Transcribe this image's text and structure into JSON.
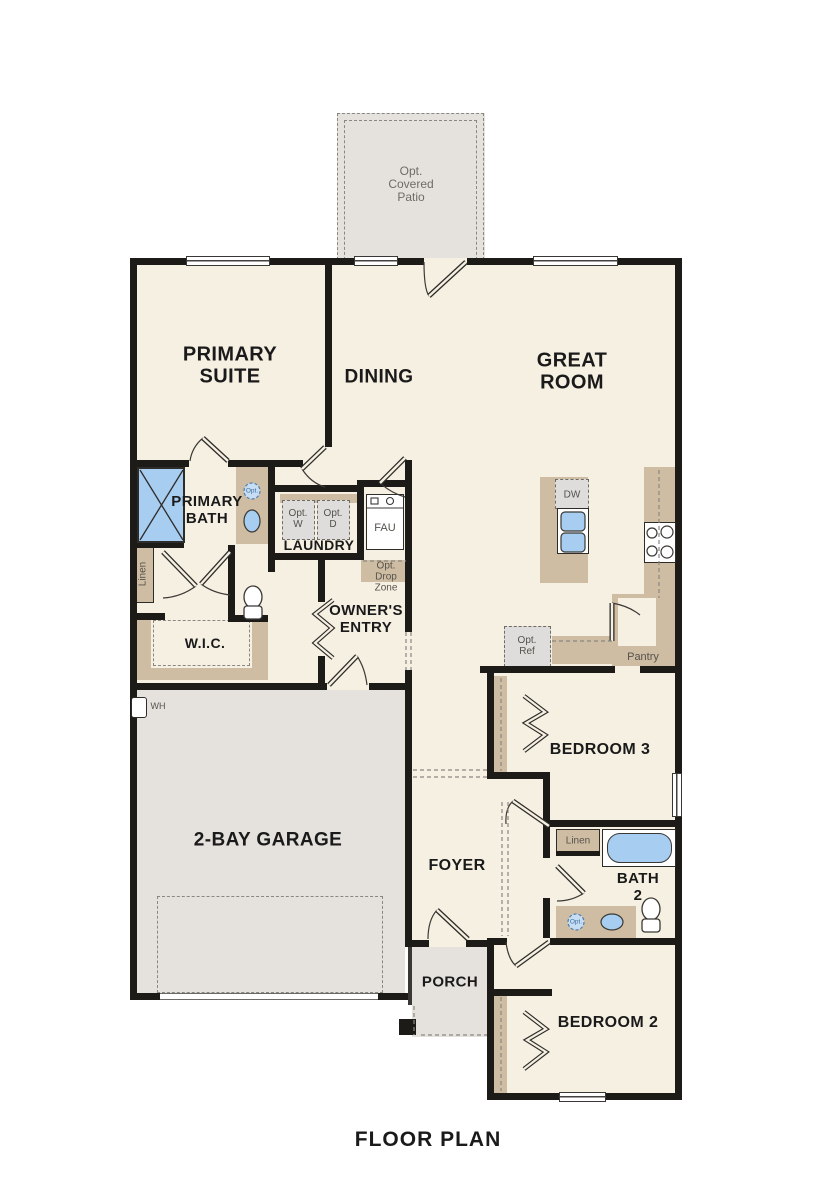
{
  "plan": {
    "title": "FLOOR PLAN",
    "rooms": {
      "patio": "Opt.\nCovered\nPatio",
      "primary_suite": "PRIMARY\nSUITE",
      "dining": "DINING",
      "great_room": "GREAT\nROOM",
      "primary_bath": "PRIMARY\nBATH",
      "laundry": "LAUNDRY",
      "wic": "W.I.C.",
      "owners_entry": "OWNER'S\nENTRY",
      "garage": "2-BAY GARAGE",
      "foyer": "FOYER",
      "porch": "PORCH",
      "bedroom3": "BEDROOM 3",
      "bath2": "BATH\n2",
      "bedroom2": "BEDROOM 2"
    },
    "fixtures": {
      "dw": "DW",
      "fau": "FAU",
      "wh": "WH",
      "pantry": "Pantry",
      "linen": "Linen",
      "opt_washer": "Opt.\nW",
      "opt_dryer": "Opt.\nD",
      "opt_ref": "Opt.\nRef",
      "opt_drop_zone": "Opt.\nDrop\nZone",
      "opt_sink": "Opt."
    },
    "colors": {
      "wall": "#1d1b18",
      "floor": "#f5f0e2",
      "concrete": "#e5e2de",
      "cabinet": "#cfbda3",
      "fixture_blue": "#a7cdf1",
      "appliance": "#dedddb",
      "dash": "#8a8783",
      "label": "#1a1a1a",
      "small_label": "#55524c"
    }
  }
}
